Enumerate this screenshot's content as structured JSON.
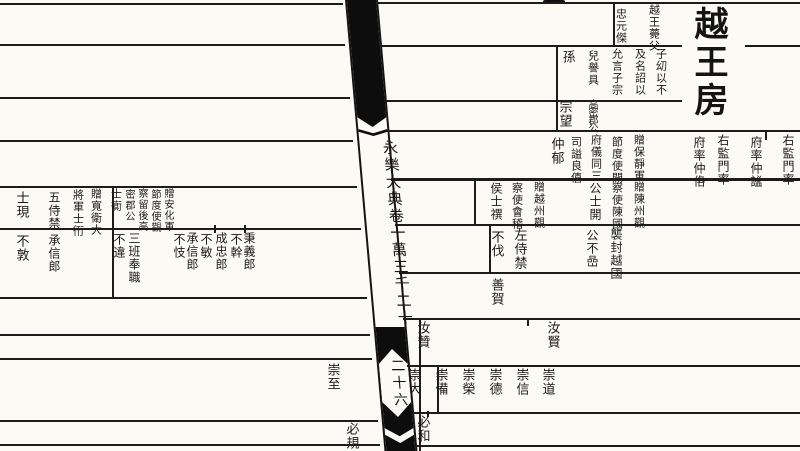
{
  "colors": {
    "paper": "#fbfaf5",
    "ink": "#1a1a1a",
    "bar": "#0d0d0d"
  },
  "spine": {
    "title": "永樂大典卷一萬三千二十",
    "folio": "二十六"
  },
  "right_page": {
    "house_title": "越王房",
    "columns": [
      {
        "text": "越王薨父",
        "x": 655,
        "y": 4,
        "size": 11
      },
      {
        "text": "忠元傑",
        "x": 622,
        "y": 8,
        "size": 11
      },
      {
        "text": "子㓜以不",
        "x": 662,
        "y": 48,
        "size": 11
      },
      {
        "text": "及名詔以",
        "x": 641,
        "y": 48,
        "size": 11
      },
      {
        "text": "允言子宗",
        "x": 618,
        "y": 48,
        "size": 11
      },
      {
        "text": "兒譽具",
        "x": 594,
        "y": 50,
        "size": 11
      },
      {
        "text": "孫",
        "x": 568,
        "y": 50,
        "size": 13
      },
      {
        "text": "高密郡公",
        "x": 592,
        "y": 99,
        "size": 10,
        "ls": -2
      },
      {
        "text": "宗望",
        "x": 565,
        "y": 100,
        "size": 13
      },
      {
        "text": "右監門率",
        "x": 789,
        "y": 134,
        "size": 12
      },
      {
        "text": "府率仲謐",
        "x": 757,
        "y": 136,
        "size": 12
      },
      {
        "text": "右監門率",
        "x": 724,
        "y": 134,
        "size": 12
      },
      {
        "text": "府率仲佫",
        "x": 700,
        "y": 136,
        "size": 12
      },
      {
        "text": "贈保靜軍",
        "x": 640,
        "y": 134,
        "size": 11
      },
      {
        "text": "節度使開",
        "x": 618,
        "y": 136,
        "size": 11
      },
      {
        "text": "府儀同三",
        "x": 597,
        "y": 134,
        "size": 11
      },
      {
        "text": "司謚良僖",
        "x": 577,
        "y": 136,
        "size": 11
      },
      {
        "text": "仲郁",
        "x": 557,
        "y": 137,
        "size": 13
      },
      {
        "text": "贈陳州觀",
        "x": 640,
        "y": 181,
        "size": 11
      },
      {
        "text": "察使陳國",
        "x": 618,
        "y": 182,
        "size": 11
      },
      {
        "text": "公士開",
        "x": 596,
        "y": 182,
        "size": 12
      },
      {
        "text": "贈越州觀",
        "x": 540,
        "y": 181,
        "size": 11
      },
      {
        "text": "察使會稽",
        "x": 518,
        "y": 182,
        "size": 11
      },
      {
        "text": "侯士禩",
        "x": 497,
        "y": 182,
        "size": 12
      },
      {
        "text": "襲封越國",
        "x": 617,
        "y": 228,
        "size": 12
      },
      {
        "text": "公不嵒",
        "x": 593,
        "y": 229,
        "size": 12
      },
      {
        "text": "左侍禁",
        "x": 520,
        "y": 228,
        "size": 13
      },
      {
        "text": "不伐",
        "x": 497,
        "y": 230,
        "size": 13
      },
      {
        "text": "善賀",
        "x": 497,
        "y": 278,
        "size": 13
      },
      {
        "text": "汝賢",
        "x": 553,
        "y": 321,
        "size": 13
      },
      {
        "text": "汝贊",
        "x": 423,
        "y": 321,
        "size": 13
      },
      {
        "text": "崇道",
        "x": 548,
        "y": 368,
        "size": 13
      },
      {
        "text": "崇信",
        "x": 522,
        "y": 368,
        "size": 13
      },
      {
        "text": "崇德",
        "x": 495,
        "y": 368,
        "size": 13
      },
      {
        "text": "崇榮",
        "x": 468,
        "y": 368,
        "size": 13
      },
      {
        "text": "崇備",
        "x": 441,
        "y": 368,
        "size": 13
      },
      {
        "text": "崇大",
        "x": 414,
        "y": 368,
        "size": 13
      },
      {
        "text": "必和",
        "x": 423,
        "y": 415,
        "size": 13
      }
    ]
  },
  "left_page": {
    "columns": [
      {
        "text": "贈安化軍",
        "x": 168,
        "y": 188,
        "size": 10
      },
      {
        "text": "節度使觀",
        "x": 155,
        "y": 189,
        "size": 10
      },
      {
        "text": "察留後高",
        "x": 142,
        "y": 188,
        "size": 10
      },
      {
        "text": "密郡公",
        "x": 129,
        "y": 189,
        "size": 10
      },
      {
        "text": "士衠",
        "x": 117,
        "y": 188,
        "size": 11
      },
      {
        "text": "贈寬衛大",
        "x": 97,
        "y": 188,
        "size": 11
      },
      {
        "text": "將軍士衎",
        "x": 79,
        "y": 189,
        "size": 11
      },
      {
        "text": "五侍禁",
        "x": 55,
        "y": 191,
        "size": 12
      },
      {
        "text": "士現",
        "x": 22,
        "y": 191,
        "size": 13
      },
      {
        "text": "秉義郎",
        "x": 250,
        "y": 232,
        "size": 12
      },
      {
        "text": "不幹",
        "x": 237,
        "y": 233,
        "size": 12
      },
      {
        "text": "成忠郎",
        "x": 222,
        "y": 232,
        "size": 12
      },
      {
        "text": "不敏",
        "x": 207,
        "y": 233,
        "size": 12
      },
      {
        "text": "承信郎",
        "x": 193,
        "y": 232,
        "size": 12
      },
      {
        "text": "不忮",
        "x": 180,
        "y": 233,
        "size": 12
      },
      {
        "text": "三班奉職",
        "x": 135,
        "y": 232,
        "size": 12
      },
      {
        "text": "不違",
        "x": 120,
        "y": 233,
        "size": 12
      },
      {
        "text": "承信郎",
        "x": 55,
        "y": 234,
        "size": 12
      },
      {
        "text": "不敦",
        "x": 22,
        "y": 234,
        "size": 13
      },
      {
        "text": "崇至",
        "x": 333,
        "y": 363,
        "size": 13
      },
      {
        "text": "必規",
        "x": 352,
        "y": 422,
        "size": 13
      }
    ]
  }
}
